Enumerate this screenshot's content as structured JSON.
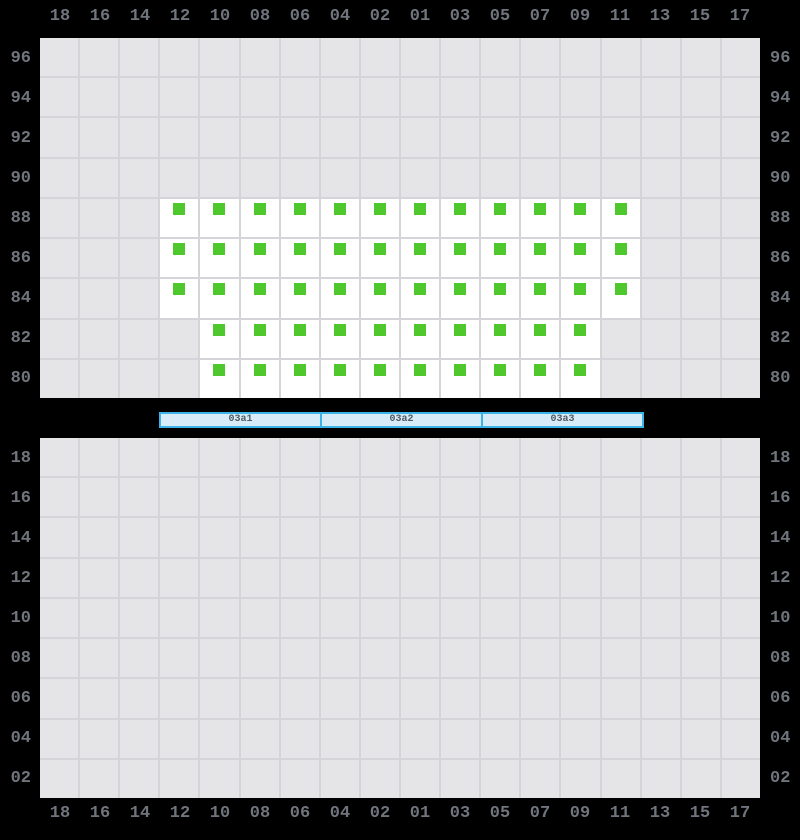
{
  "window": {
    "width": 800,
    "height": 840,
    "background": "#000000"
  },
  "colors": {
    "grid_fill": "#e5e5e7",
    "grid_line": "#d4d5d9",
    "seat_fill": "#ffffff",
    "seat_marker": "#4ec82c",
    "label_text": "#70747d",
    "stage_border": "#3cb4e8",
    "stage_fill": "#d6ecf8",
    "stage_text": "#525a63"
  },
  "columns": [
    "18",
    "16",
    "14",
    "12",
    "10",
    "08",
    "06",
    "04",
    "02",
    "01",
    "03",
    "05",
    "07",
    "09",
    "11",
    "13",
    "15",
    "17"
  ],
  "upper_panel": {
    "row_labels": [
      "96",
      "94",
      "92",
      "90",
      "88",
      "86",
      "84",
      "82",
      "80"
    ],
    "seat_state": "available",
    "seat_rows": [
      {
        "row": "88",
        "seats": [
          "12",
          "10",
          "08",
          "06",
          "04",
          "02",
          "01",
          "03",
          "05",
          "07",
          "09",
          "11"
        ]
      },
      {
        "row": "86",
        "seats": [
          "12",
          "10",
          "08",
          "06",
          "04",
          "02",
          "01",
          "03",
          "05",
          "07",
          "09",
          "11"
        ]
      },
      {
        "row": "84",
        "seats": [
          "12",
          "10",
          "08",
          "06",
          "04",
          "02",
          "01",
          "03",
          "05",
          "07",
          "09",
          "11"
        ]
      },
      {
        "row": "82",
        "seats": [
          "10",
          "08",
          "06",
          "04",
          "02",
          "01",
          "03",
          "05",
          "07",
          "09"
        ]
      },
      {
        "row": "80",
        "seats": [
          "10",
          "08",
          "06",
          "04",
          "02",
          "01",
          "03",
          "05",
          "07",
          "09"
        ]
      }
    ]
  },
  "section_bar": {
    "segments": [
      {
        "label": "03a1"
      },
      {
        "label": "03a2"
      },
      {
        "label": "03a3"
      }
    ]
  },
  "lower_panel": {
    "row_labels": [
      "18",
      "16",
      "14",
      "12",
      "10",
      "08",
      "06",
      "04",
      "02"
    ],
    "seat_rows": []
  }
}
